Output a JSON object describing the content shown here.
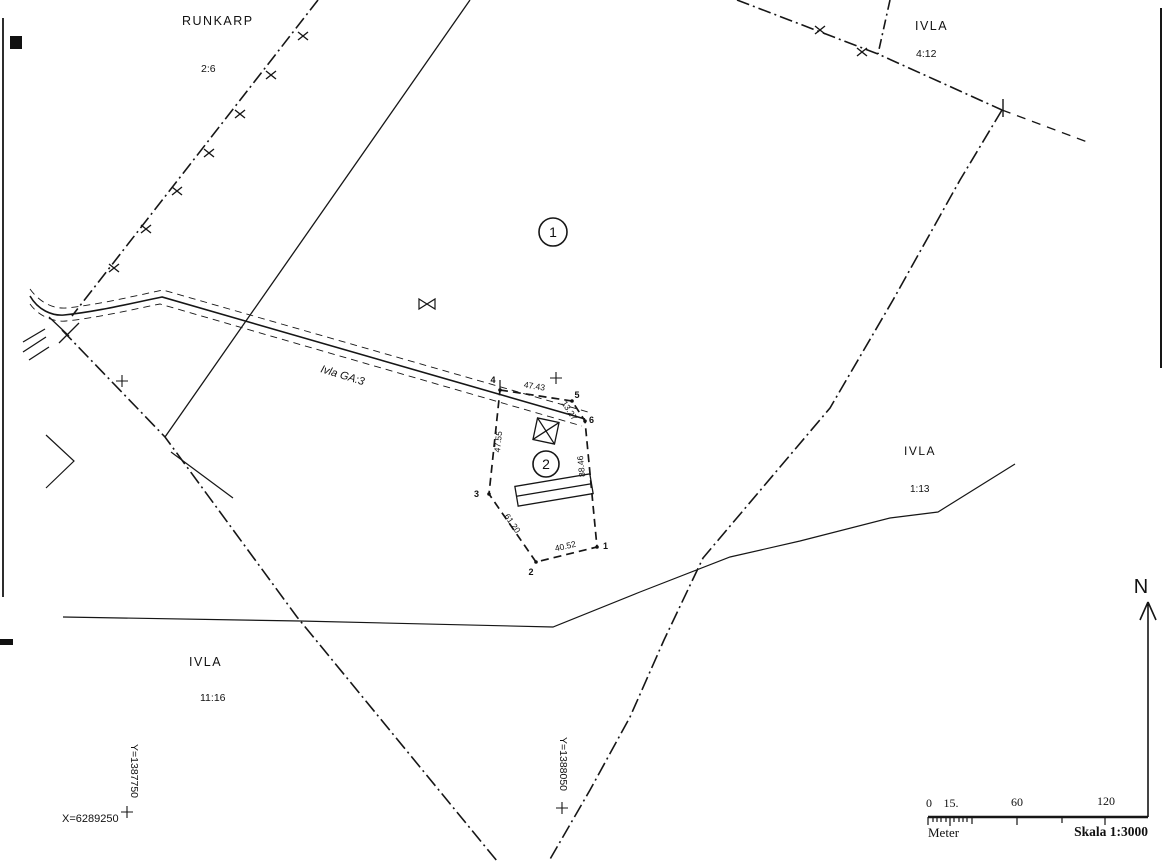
{
  "parcels": [
    {
      "name": "RUNKARP",
      "code": "2:6"
    },
    {
      "name": "IVLA",
      "code": "4:12"
    },
    {
      "name": "IVLA",
      "code": "1:13"
    },
    {
      "name": "IVLA",
      "code": "11:16"
    }
  ],
  "areas": [
    "1",
    "2"
  ],
  "road": {
    "label": "Ivla GA:3"
  },
  "parcel2_survey": {
    "vertices": [
      "1",
      "2",
      "3",
      "4",
      "5",
      "6"
    ],
    "edges": [
      {
        "between": "4-5",
        "length": "47.43"
      },
      {
        "between": "5-6",
        "length": "13.27"
      },
      {
        "between": "6-1",
        "length": "88.46"
      },
      {
        "between": "1-2",
        "length": "40.52"
      },
      {
        "between": "2-3",
        "length": "61.20"
      },
      {
        "between": "3-4",
        "length": "47.55"
      }
    ]
  },
  "grid_coordinates": {
    "x": "X=6289250",
    "y_west": "Y=1387750",
    "y_east": "Y=1388050"
  },
  "north": {
    "label": "N"
  },
  "scale_bar": {
    "ticks": [
      "0",
      "15.",
      "60",
      "120"
    ],
    "unit": "Meter",
    "scale_text": "Skala 1:3000"
  },
  "colors": {
    "ink": "#161616",
    "paper": "#ffffff"
  }
}
